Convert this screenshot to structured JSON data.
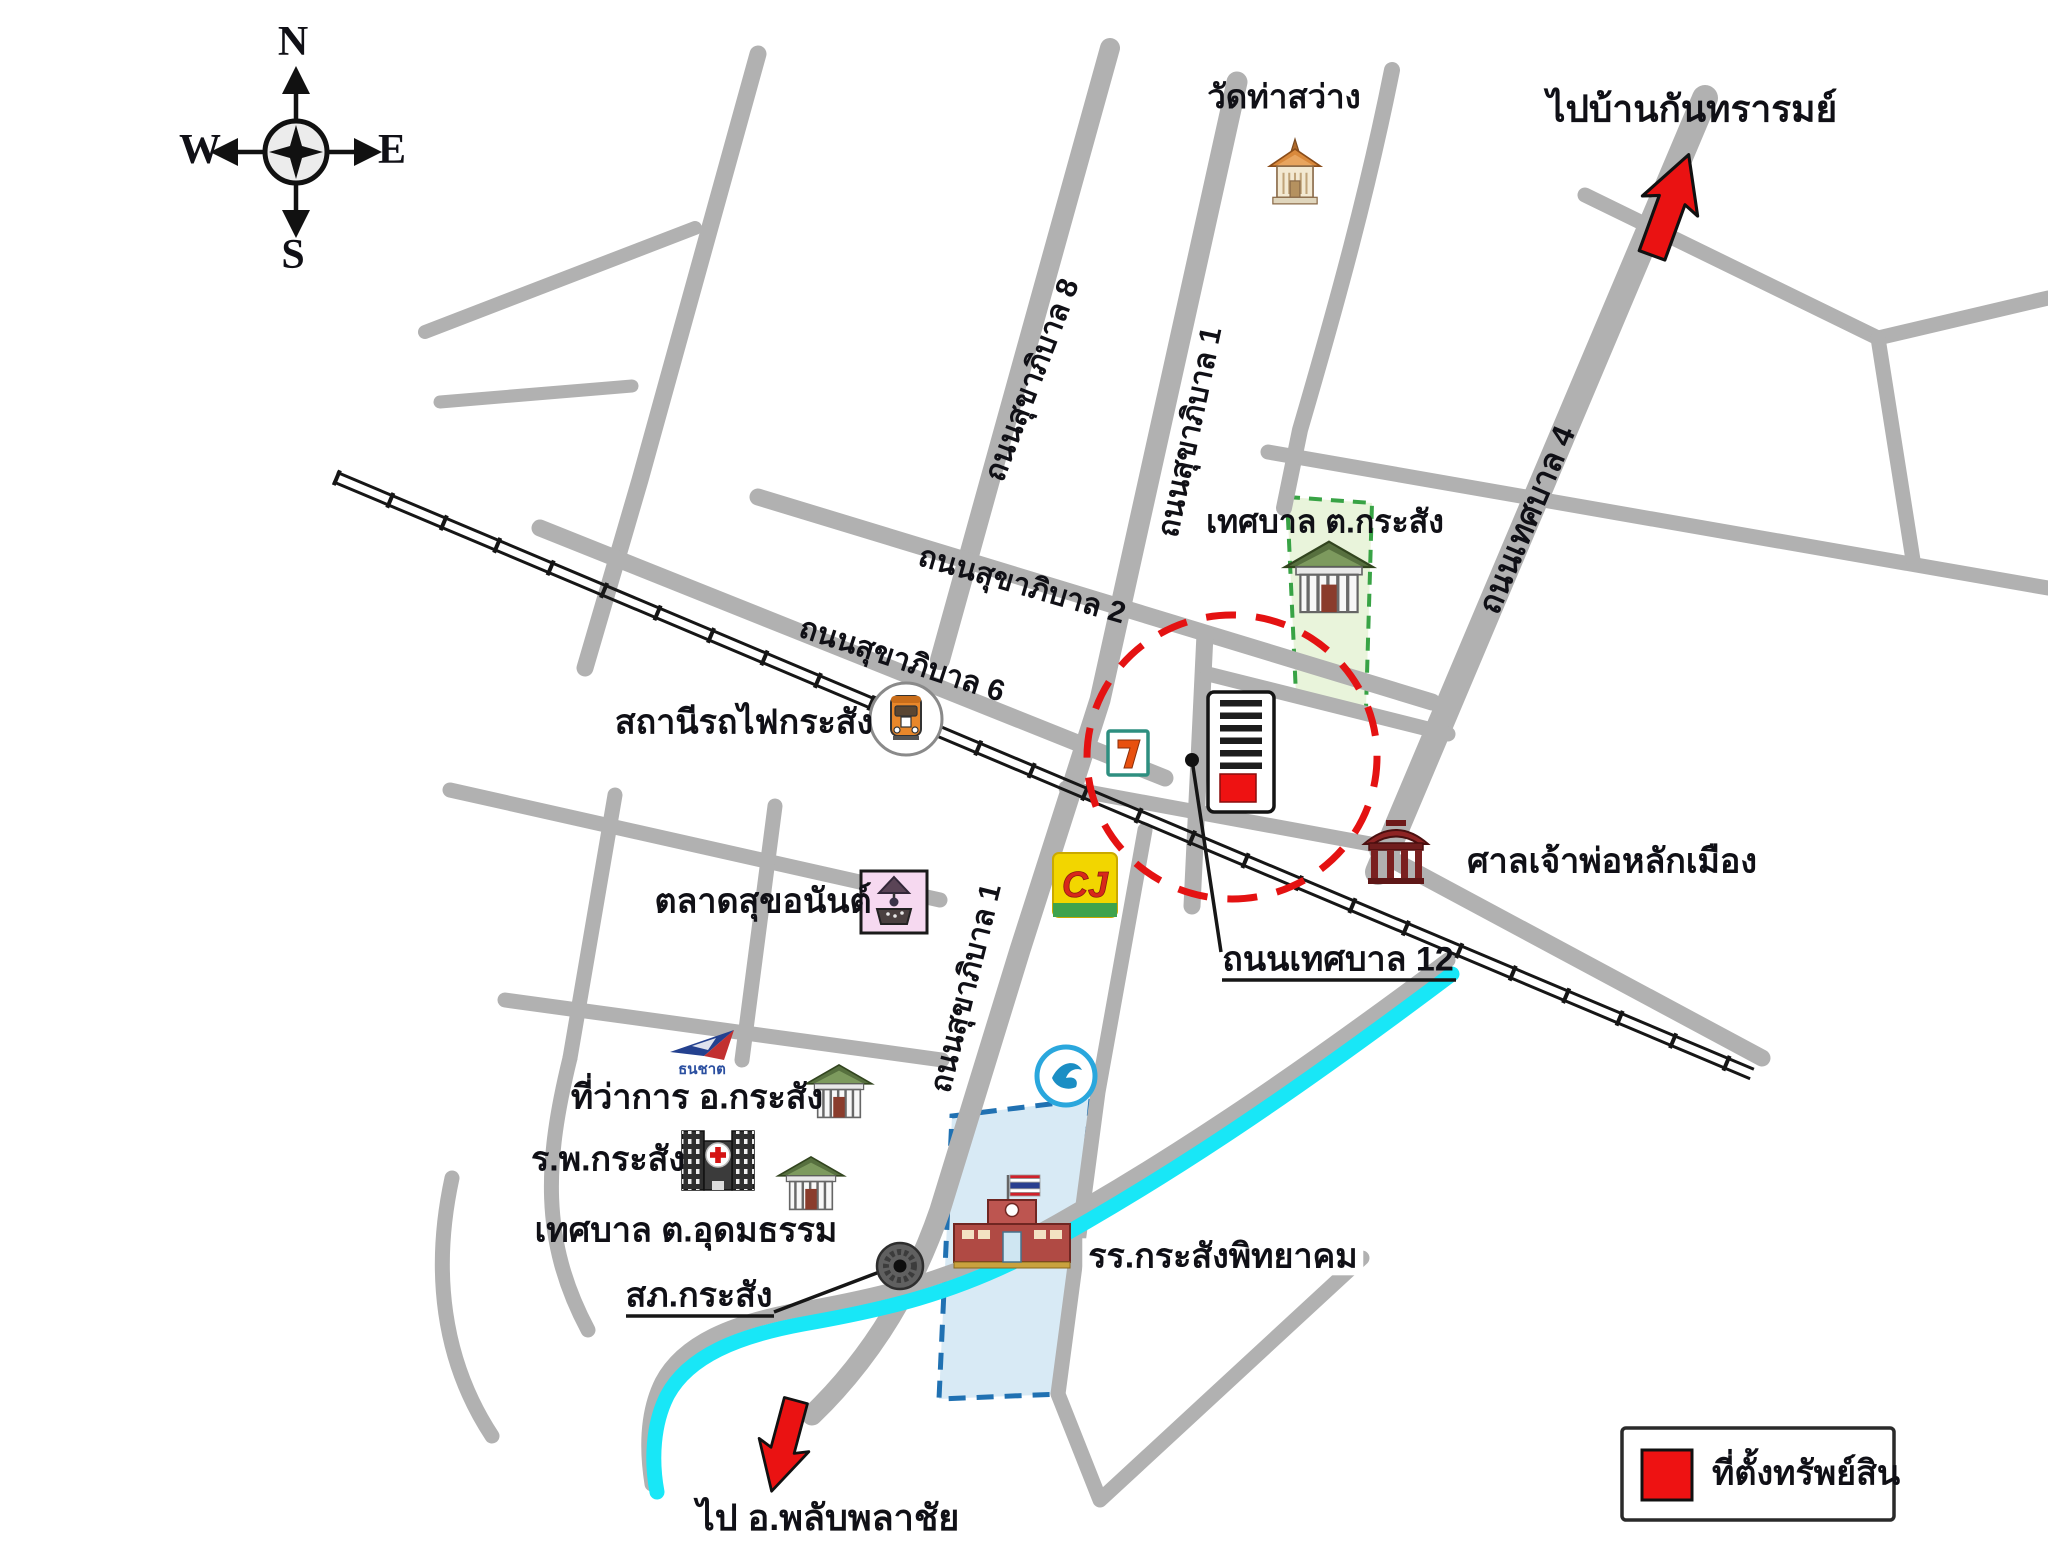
{
  "compass": {
    "n": "N",
    "e": "E",
    "s": "S",
    "w": "W"
  },
  "destinations": {
    "northeast": "ไปบ้านกันทรารมย์",
    "south": "ไป อ.พลับพลาชัย"
  },
  "roads": {
    "sukhaphiban8": "ถนนสุขาภิบาล 8",
    "sukhaphiban1_north": "ถนนสุขาภิบาล 1",
    "sukhaphiban2": "ถนนสุขาภิบาล 2",
    "sukhaphiban6": "ถนนสุขาภิบาล 6",
    "sukhaphiban1_south": "ถนนสุขาภิบาล 1",
    "thesaban4": "ถนนเทศบาล 4",
    "thesaban12": "ถนนเทศบาล 12"
  },
  "places": {
    "temple": "วัดท่าสว่าง",
    "municipality_krasang": "เทศบาล ต.กระสัง",
    "train_station": "สถานีรถไฟกระสัง",
    "city_pillar_shrine": "ศาลเจ้าพ่อหลักเมือง",
    "market": "ตลาดสุขอนันต์",
    "district_office": "ที่ว่าการ อ.กระสัง",
    "hospital": "ร.พ.กระสัง",
    "municipality_udomtham": "เทศบาล ต.อุดมธรรม",
    "police_station": "สภ.กระสัง",
    "school": "รร.กระสังพิทยาคม"
  },
  "legend": {
    "property_label": "ที่ตั้งทรัพย์สิน"
  },
  "brands": {
    "cj": "CJ",
    "seven_eleven": "7",
    "thanachart": "ธนชาต"
  },
  "icons": {
    "compass": "compass-rose-icon",
    "temple": "thai-temple-icon",
    "government": "government-building-icon",
    "train": "train-station-icon",
    "seven_eleven": "seven-eleven-icon",
    "cj": "cj-supermarket-icon",
    "krungthai": "krungthai-bank-icon",
    "thanachart": "thanachart-bank-icon",
    "market": "market-icon",
    "hospital": "hospital-icon",
    "shrine": "chinese-shrine-icon",
    "police": "police-station-icon",
    "school": "school-icon",
    "property": "property-building-icon",
    "arrow": "red-direction-arrow-icon"
  },
  "colors": {
    "road": "#b1b1b1",
    "rail": "#161616",
    "river": "#18e7f7",
    "highlight": "#e41212",
    "arrow_red": "#ea1212",
    "legend_red": "#ee1212",
    "zone_green": "#38a345",
    "zone_green_fill": "#e9f4db",
    "zone_blue": "#2071b2",
    "zone_blue_fill": "#d8eaf5",
    "label": "#101016"
  }
}
